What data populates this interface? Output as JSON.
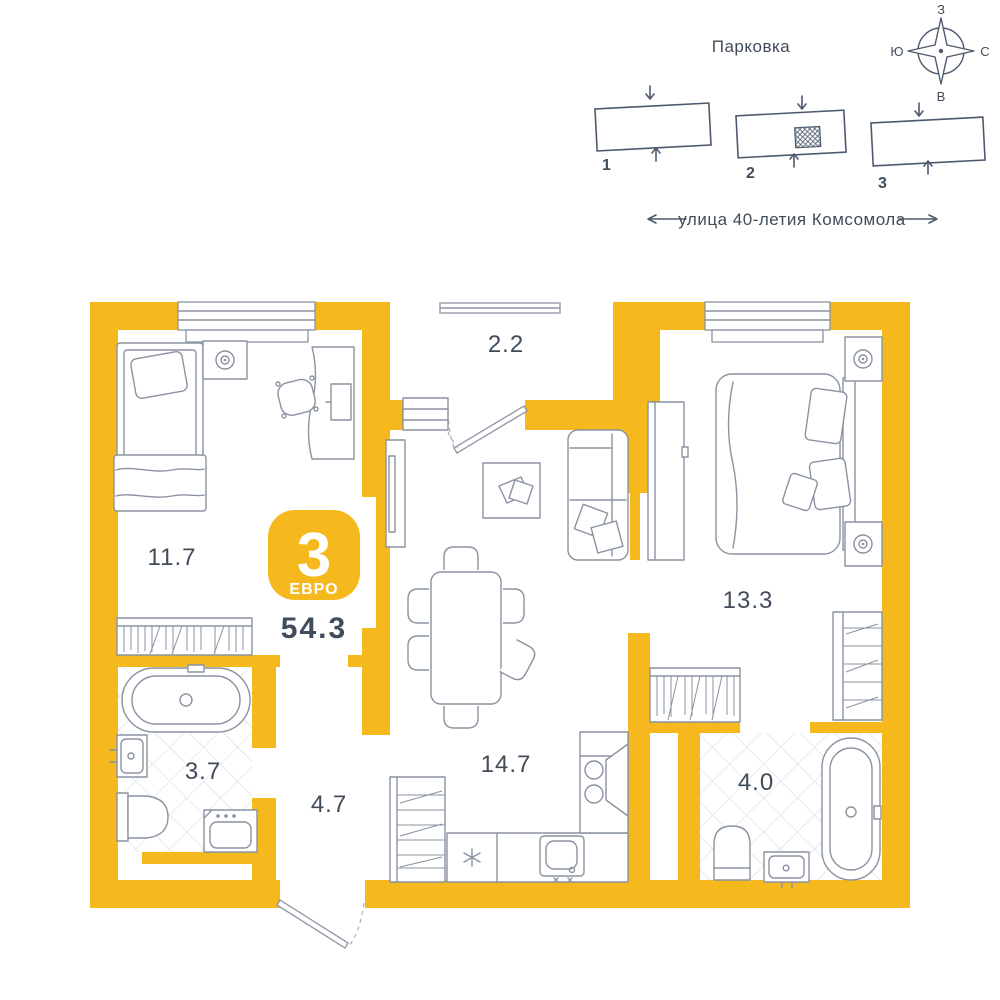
{
  "colors": {
    "wall": "#f5b81d",
    "line": "#4d5a6e",
    "ink": "#414c5a",
    "furn": "#8a93a1",
    "tile": "#d9dde3"
  },
  "site_plan": {
    "title": "Парковка",
    "street": "улица 40-летия Комсомола",
    "buildings": [
      {
        "label": "1"
      },
      {
        "label": "2"
      },
      {
        "label": "3"
      }
    ],
    "current_building": "2"
  },
  "compass": {
    "top": "З",
    "left": "Ю",
    "right": "С",
    "bottom": "В"
  },
  "apartment": {
    "rooms_count": "3",
    "layout_type": "ЕВРО",
    "total_area": "54.3",
    "rooms": [
      {
        "id": "bedroom-1",
        "area": "11.7"
      },
      {
        "id": "balcony",
        "area": "2.2"
      },
      {
        "id": "bedroom-2",
        "area": "13.3"
      },
      {
        "id": "bathroom-1",
        "area": "3.7"
      },
      {
        "id": "hallway",
        "area": "4.7"
      },
      {
        "id": "kitchen-living",
        "area": "14.7"
      },
      {
        "id": "bathroom-2",
        "area": "4.0"
      }
    ]
  }
}
